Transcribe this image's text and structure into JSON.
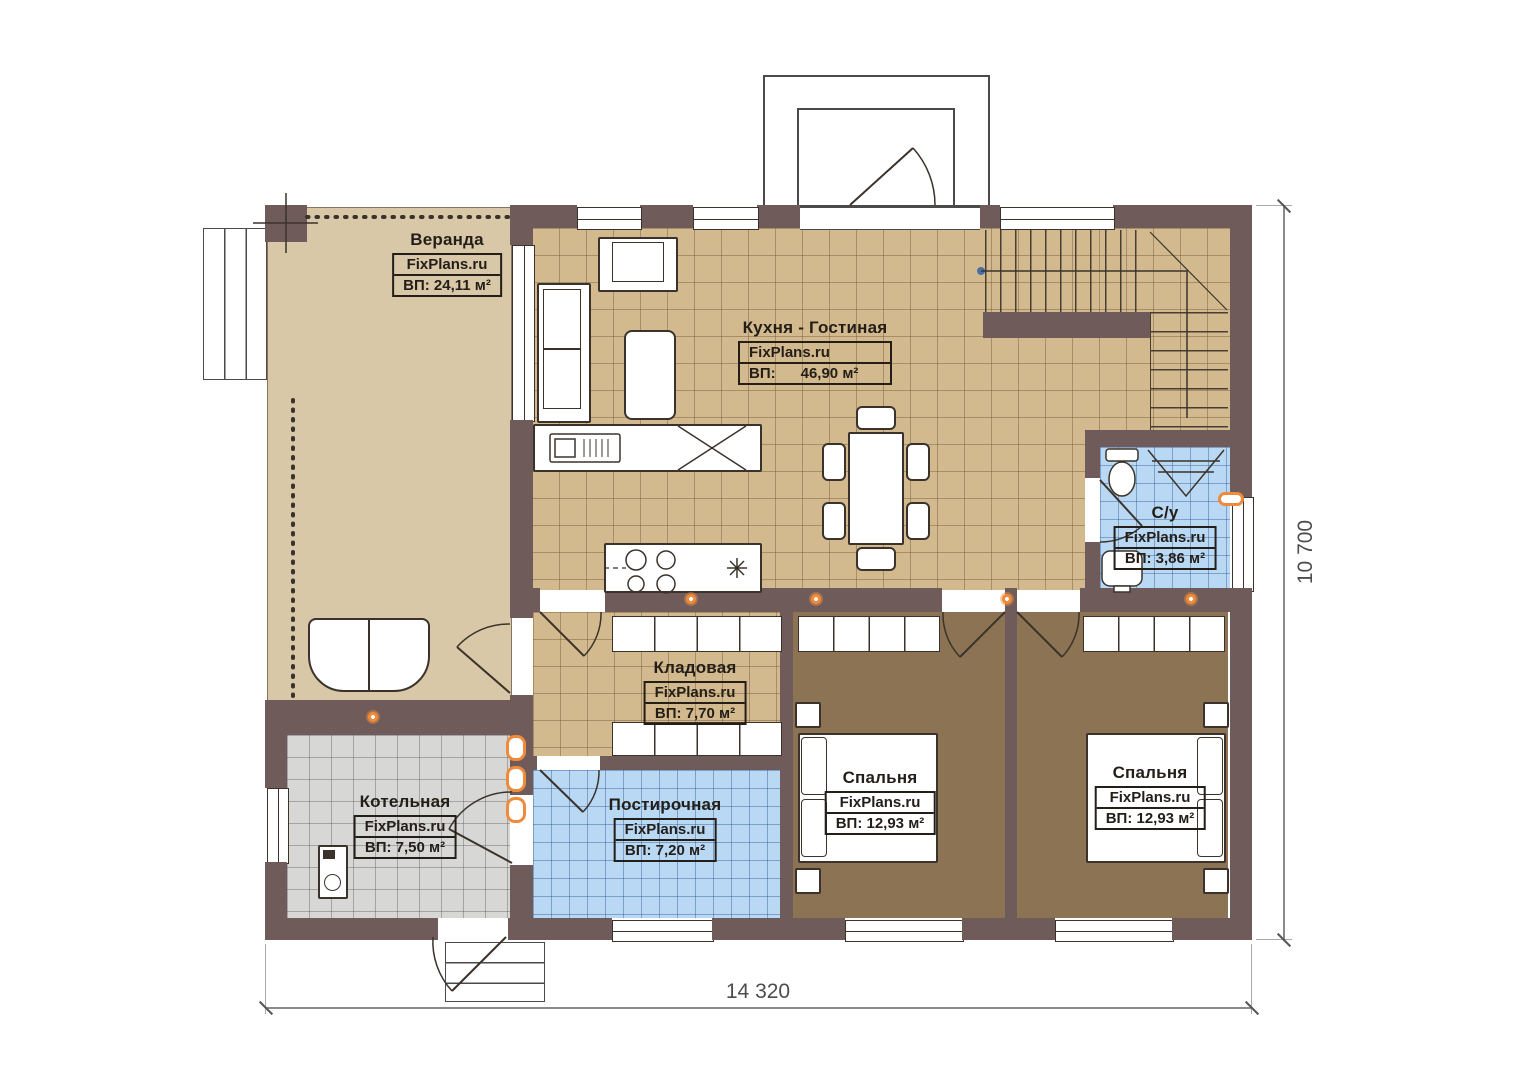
{
  "plan": {
    "brand": "FixPlans.ru",
    "dimensions": {
      "bottom": "14 320",
      "right": "10 700"
    },
    "rooms": [
      {
        "name": "Веранда",
        "brand": "FixPlans.ru",
        "area": "ВП: 24,11 м²"
      },
      {
        "name": "Кухня - Гостиная",
        "brand": "FixPlans.ru",
        "area": "ВП:      46,90 м²"
      },
      {
        "name": "С/у",
        "brand": "FixPlans.ru",
        "area": "ВП: 3,86 м²"
      },
      {
        "name": "Кладовая",
        "brand": "FixPlans.ru",
        "area": "ВП: 7,70 м²"
      },
      {
        "name": "Котельная",
        "brand": "FixPlans.ru",
        "area": "ВП: 7,50 м²"
      },
      {
        "name": "Постирочная",
        "brand": "FixPlans.ru",
        "area": "ВП: 7,20 м²"
      },
      {
        "name": "Спальня",
        "brand": "FixPlans.ru",
        "area": "ВП: 12,93 м²"
      },
      {
        "name": "Спальня",
        "brand": "FixPlans.ru",
        "area": "ВП: 12,93 м²"
      }
    ],
    "colors": {
      "wall": "#6f5c5a",
      "floor_tan": "#d3ba8e",
      "floor_veranda": "#d9c8a7",
      "floor_blue": "#b9d8f3",
      "floor_gray": "#d7d7d5",
      "floor_brown": "#8c7354",
      "accent_orange": "#ef8b3a"
    }
  }
}
